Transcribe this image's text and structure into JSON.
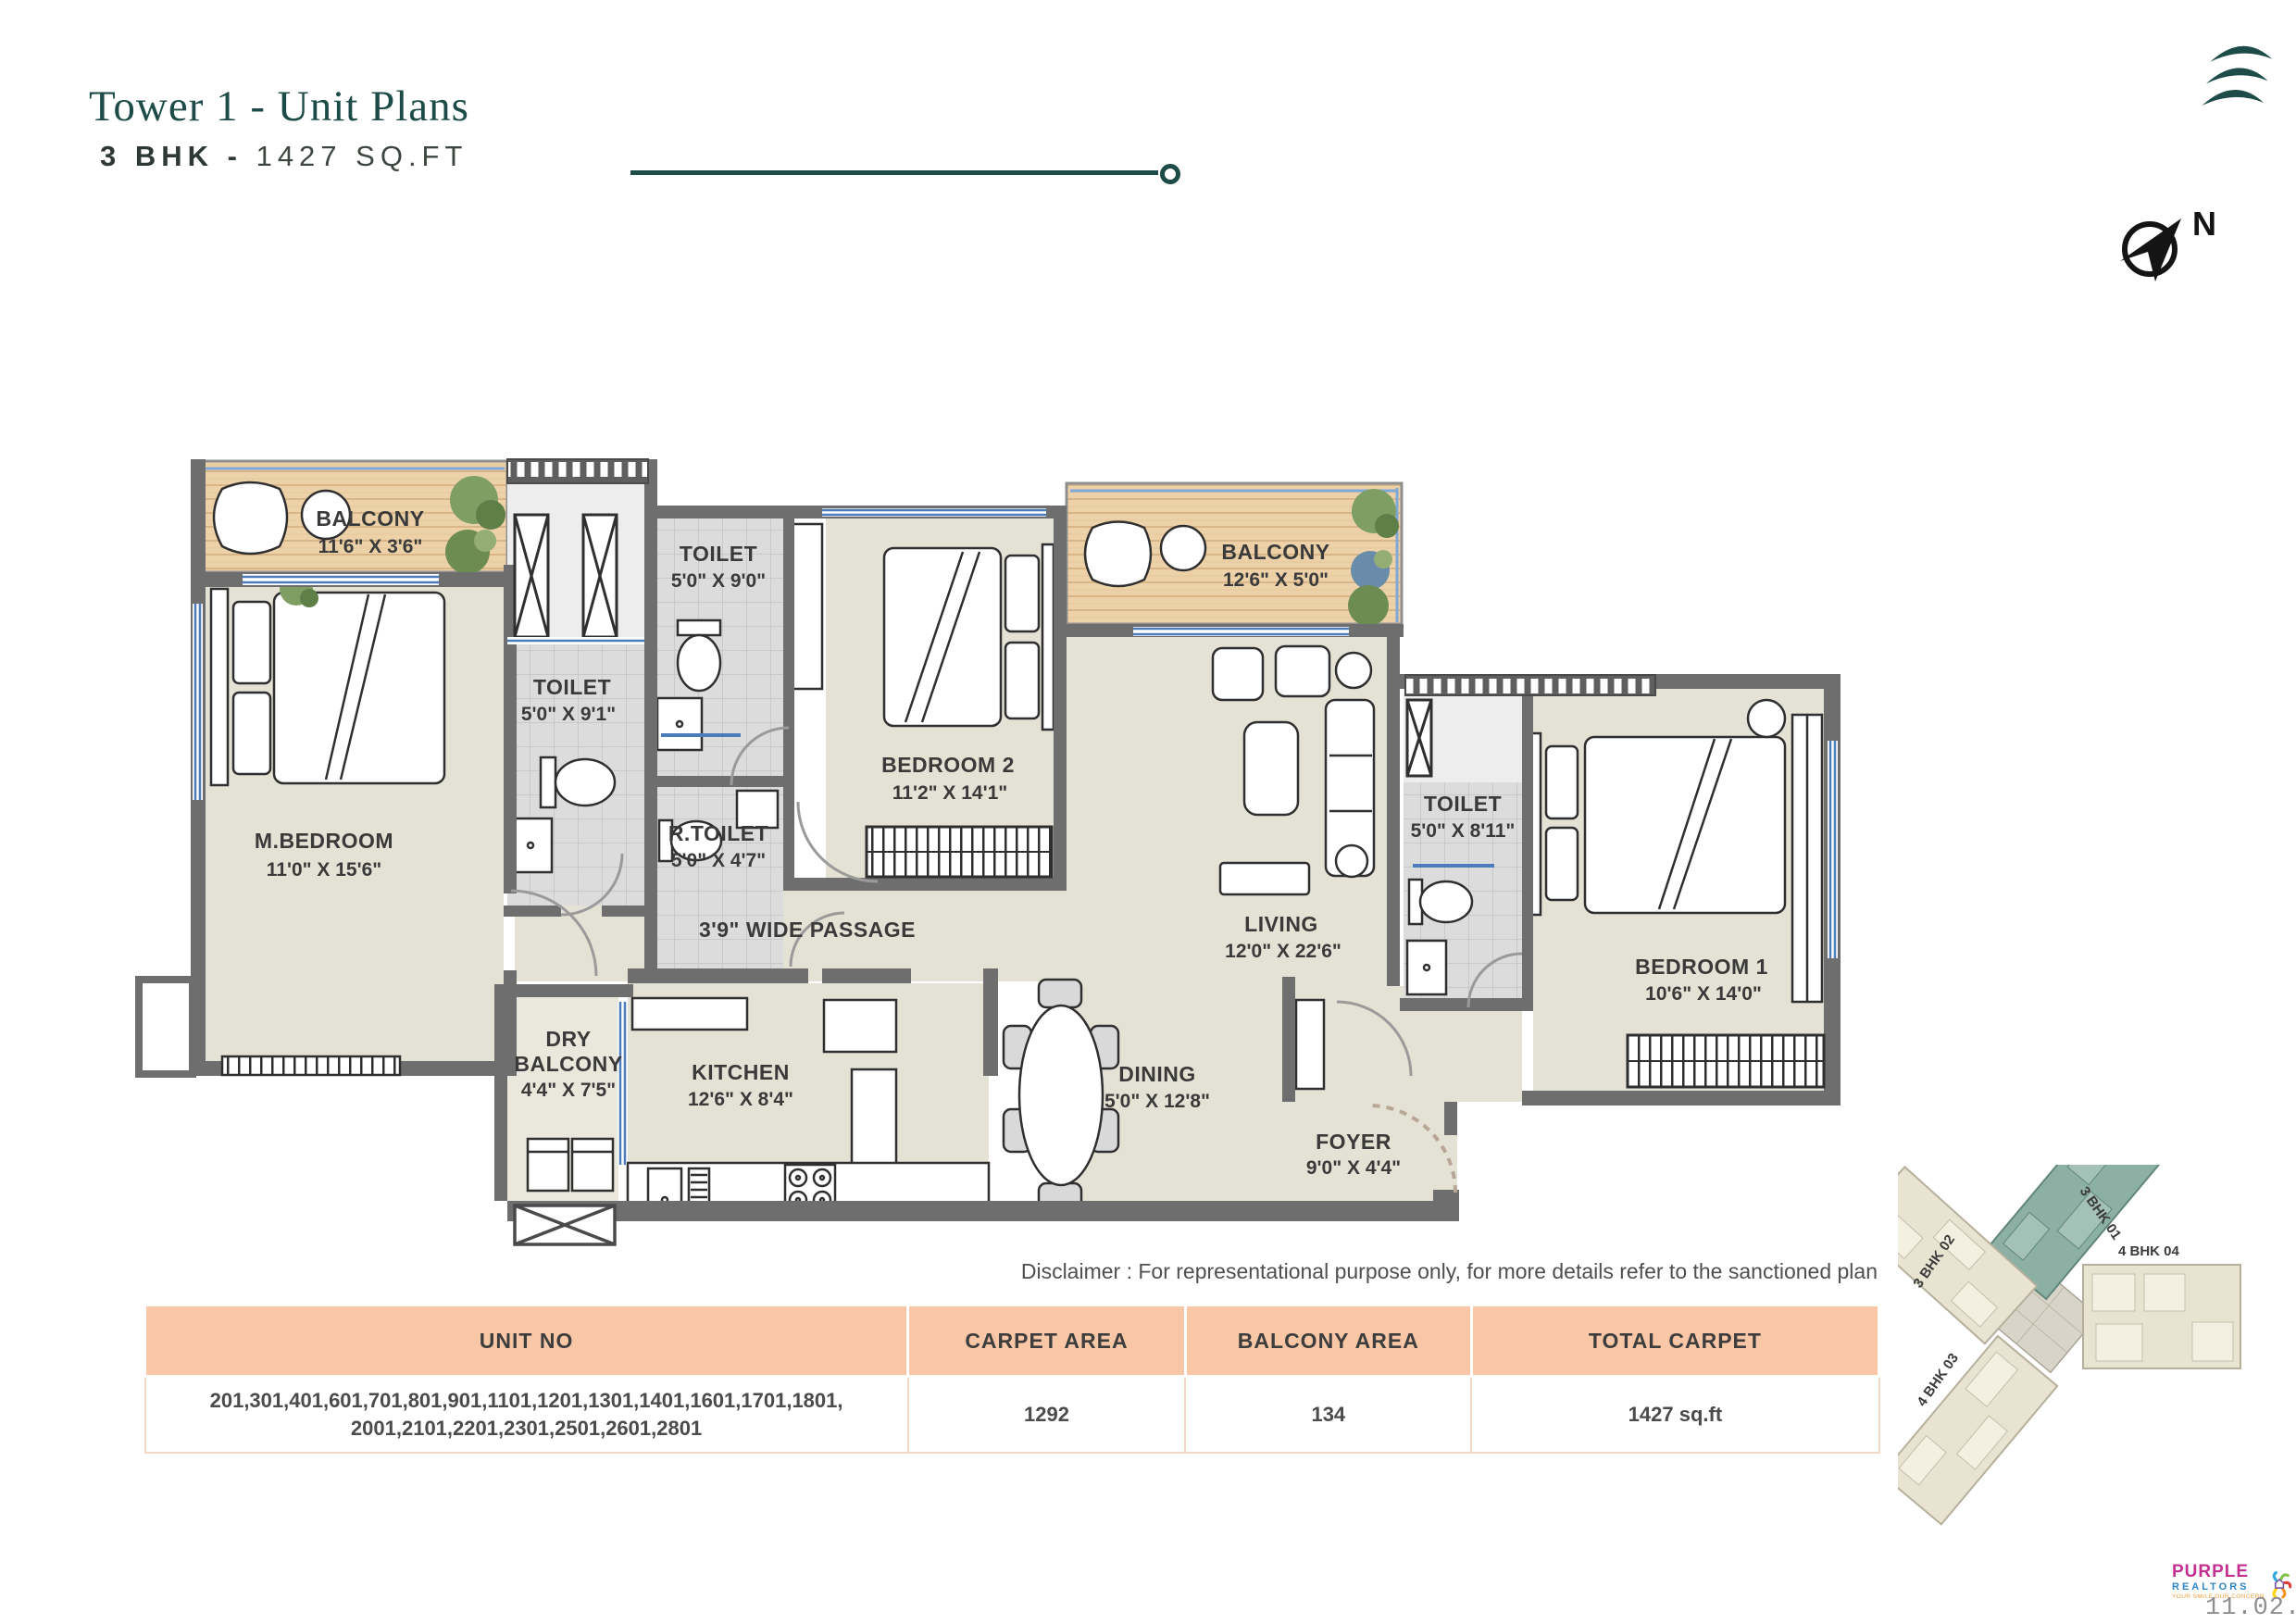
{
  "header": {
    "title": "Tower 1 - Unit Plans",
    "subtitle_bold": "3 BHK -",
    "subtitle_rest": "1427 SQ.FT",
    "compass_label": "N"
  },
  "floorplan": {
    "rooms": [
      {
        "name": "BALCONY",
        "dims": "11'6\" X 3'6\""
      },
      {
        "name": "M.BEDROOM",
        "dims": "11'0\" X 15'6\""
      },
      {
        "name": "TOILET",
        "dims": "5'0\" X 9'1\""
      },
      {
        "name": "TOILET",
        "dims": "5'0\" X 9'0\""
      },
      {
        "name": "R.TOILET",
        "dims": "5'0\" X 4'7\""
      },
      {
        "name": "BEDROOM 2",
        "dims": "11'2\" X 14'1\""
      },
      {
        "name": "BALCONY",
        "dims": "12'6\" X 5'0\""
      },
      {
        "name": "LIVING",
        "dims": "12'0\" X 22'6\""
      },
      {
        "name": "TOILET",
        "dims": "5'0\" X 8'11\""
      },
      {
        "name": "BEDROOM 1",
        "dims": "10'6\" X 14'0\""
      },
      {
        "name": "3'9\" WIDE PASSAGE"
      },
      {
        "name": "DRY",
        "name2": "BALCONY",
        "dims": "4'4\" X 7'5\""
      },
      {
        "name": "KITCHEN",
        "dims": "12'6\" X 8'4\""
      },
      {
        "name": "DINING",
        "dims": "5'0\" X 12'8\""
      },
      {
        "name": "FOYER",
        "dims": "9'0\" X 4'4\""
      }
    ]
  },
  "disclaimer": "Disclaimer : For representational purpose only, for more details refer to the sanctioned plan",
  "table": {
    "headers": [
      "UNIT NO",
      "CARPET AREA",
      "BALCONY AREA",
      "TOTAL CARPET"
    ],
    "row": {
      "unit_no_line1": "201,301,401,601,701,801,901,1101,1201,1301,1401,1601,1701,1801,",
      "unit_no_line2": "2001,2101,2201,2301,2501,2601,2801",
      "carpet_area": "1292",
      "balcony_area": "134",
      "total_carpet": "1427 sq.ft"
    }
  },
  "keyplan": {
    "wings": [
      {
        "label": "3 BHK 01"
      },
      {
        "label": "3 BHK 02"
      },
      {
        "label": "4 BHK 03"
      },
      {
        "label": "4 BHK 04"
      }
    ]
  },
  "branding": {
    "name_top": "PURPLE",
    "name_bottom": "REALTORS",
    "tagline": "YOUR SMILE OUR CONCERN",
    "date": "11.02.2026"
  },
  "colors": {
    "accent_teal": "#1d4b47",
    "table_header": "#f9c7a6",
    "wall": "#6e6e6e",
    "floor": "#e4e1d5",
    "wood": "#edd2a9",
    "window_blue": "#4d7cba"
  }
}
